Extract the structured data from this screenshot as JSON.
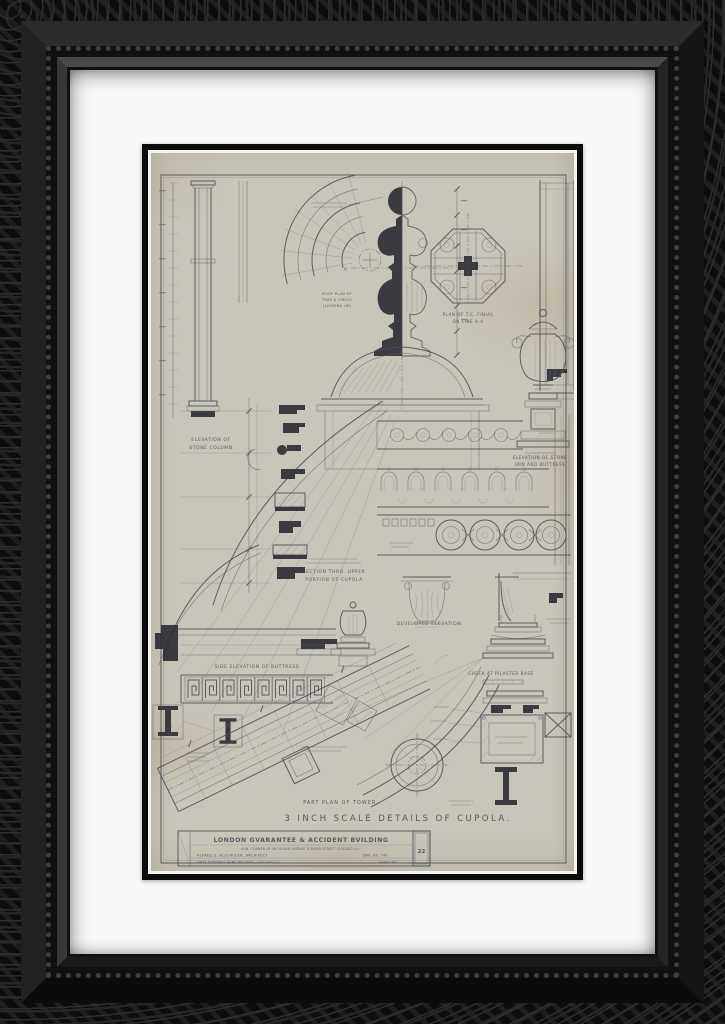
{
  "colors": {
    "frame_black": "#131313",
    "mat_white": "#f8f8f6",
    "fillet_black": "#0c0c0c",
    "paper_gray": "#c8c5ba",
    "ink": "#4d4d55",
    "stain_tan": "#a68a58"
  },
  "sheet": {
    "main_title": "3 INCH SCALE DETAILS OF CUPOLA.",
    "labels": {
      "trap_plan_1": "ROOF PLAN OF",
      "trap_plan_2": "TRAP & CIRCLE",
      "trap_plan_3": "(LOOKING UP)",
      "finial_plan_1": "PLAN OF T.C. FINIAL",
      "finial_plan_2": "ON LINE A-A",
      "column_1": "ELEVATION OF",
      "column_2": "STONE COLUMN",
      "urn_1": "ELEVATION OF STONE",
      "urn_2": "URN AND BUTTRESS",
      "section_1": "SECTION THRO. UPPER",
      "section_2": "PORTION OF CUPOLA",
      "developed": "DEVELOPED ELEVATION",
      "buttress": "SIDE ELEVATION OF BUTTRESS",
      "tower_plan": "PART PLAN OF TOWER.",
      "pilaster_base": "CHECK AT PILASTER BASE",
      "datum_a_left": "A",
      "datum_a_right": "A"
    },
    "title_block": {
      "building": "LONDON GVARANTEE & ACCIDENT BVILDING",
      "address": "N.W. CORNER OF MICHIGAN AVENUE & RIVER STREET CHICAGO ILL.",
      "architect": "ALFRED S. ALSCHULER, ARCHITECT",
      "office": "FIRST NATIONAL BANK BVILDING, CHICAGO ILL.",
      "drawing_no": "DRG. NO. 745",
      "sheet_no_label": "SHEET NO.",
      "sheet_no": "22"
    }
  }
}
